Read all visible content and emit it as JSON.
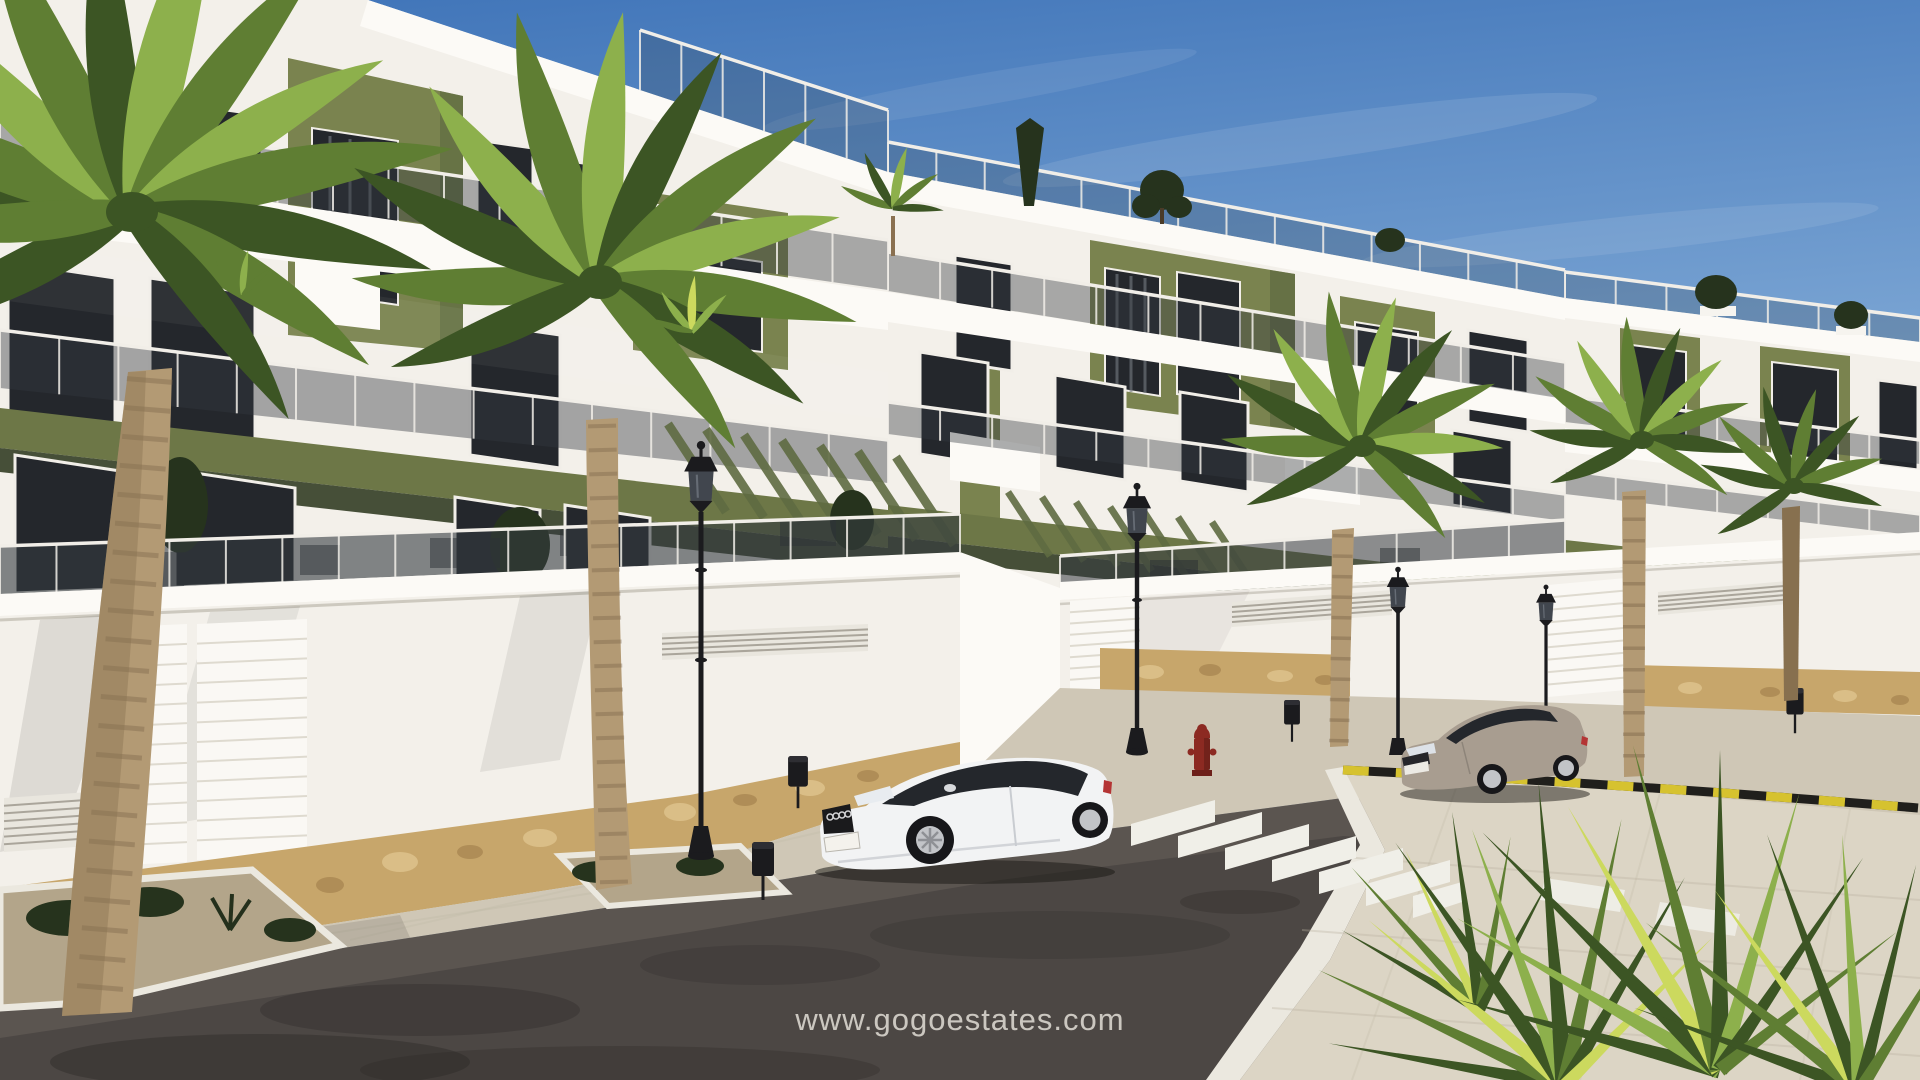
{
  "watermark": {
    "text": "www.gogoestates.com"
  },
  "scene": {
    "setting": "sunny street view of a new-build white apartment complex with olive-green accent panels, glass balconies, palm trees, a zebra crosswalk and two parked coupes",
    "objects": [
      "sky",
      "apartment-building-left",
      "apartment-building-mid",
      "apartment-building-right",
      "rooftop-plants",
      "balcony-railing",
      "pergola-louvers",
      "perimeter-wall",
      "stone-base",
      "garage-door",
      "vent-grille",
      "sidewalk",
      "planter-island",
      "street",
      "crosswalk",
      "curb-marking-yellow-black",
      "parked-car-white-coupe",
      "parked-car-gray-coupe",
      "street-lamp",
      "trash-bin",
      "fire-hydrant",
      "palm-tree",
      "fan-palm-bush",
      "watermark-text"
    ],
    "colors": {
      "sky-top": "#3e73b8",
      "sky-mid": "#7ca6d4",
      "sky-low": "#c6dcef",
      "sky-horizon": "#e6f0f8",
      "wall-white": "#f3f0ea",
      "wall-bright": "#fcfaf6",
      "wall-shadow": "#d9d4ca",
      "accent-olive": "#7a834f",
      "olive-deep": "#5e6a41",
      "olive-band": "#6d7747",
      "band-shadow": "#464f38",
      "window-dark": "#24272c",
      "glass-tint": "#343a40",
      "frame-white": "#f1eee8",
      "stone-tan": "#c7a66b",
      "stone-light": "#ddc28c",
      "stone-dark": "#a5834f",
      "door-white": "#faf8f4",
      "vent-line": "#9b968b",
      "sidewalk": "#cfc7b6",
      "sidewalk-right": "#dcd5c5",
      "paver-line": "#b9b2a0",
      "curb-white": "#ebe8df",
      "gravel": "#b3a58a",
      "road": "#4c4744",
      "road-light": "#6e6660",
      "stain": "#2b2826",
      "marking-white": "#f0efe8",
      "curb-yellow": "#d6c22f",
      "curb-black": "#201f1c",
      "car-white": "#f2f3f4",
      "car-gray": "#a89d90",
      "tire-black": "#17171a",
      "rim-silver": "#c2c4c8",
      "lamp-black": "#1b1b1e",
      "lamp-glass": "#41464e",
      "hydrant-red": "#8c2a22",
      "palm-dark": "#3c5524",
      "palm-mid": "#5f7e33",
      "palm-light": "#8db04c",
      "palm-yellow": "#ccd95e",
      "trunk-tan": "#b39a74",
      "trunk-shade": "#87704f",
      "ring-brown": "#6f5940",
      "shrub-dark": "#26331d",
      "shadow-soft": "#1e1b18",
      "watermark-color": "#e8e4dc"
    }
  }
}
